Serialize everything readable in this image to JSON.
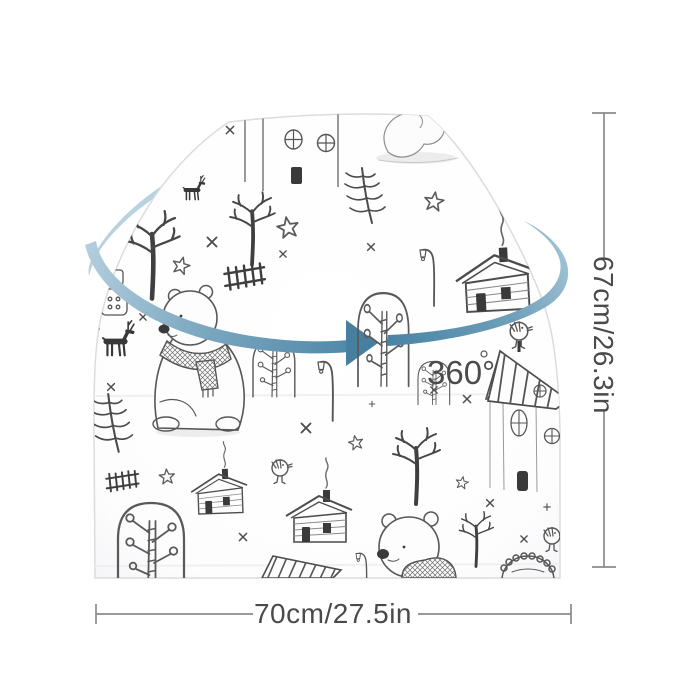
{
  "image": {
    "subject": "Stretchy baby car-seat canopy / nursing cover, white fabric with winter doodle print, shown with 360-degree rotation arrow and size annotations",
    "background": "#ffffff"
  },
  "annotations": {
    "rotation_label": "360°",
    "height_label": "67cm/26.3in",
    "width_label": "70cm/27.5in"
  },
  "colors": {
    "arrow_blue_dark": "#47809f",
    "arrow_blue_mid": "#7ba7c0",
    "arrow_blue_light": "#b6d0de",
    "dimension_line_gray": "#8b8b8b",
    "label_text_gray": "#4a4a4a",
    "doodle_ink": "#565656",
    "doodle_dark_fill": "#3a3a3a",
    "fabric_white": "#fdfdfe"
  },
  "pattern_motifs": [
    "sleeping bear on snow mound",
    "sitting bear with knitted scarf",
    "bear in knit sweater",
    "log cabins with smoking chimneys",
    "tall house with striped gable roof",
    "bare winter trees",
    "pine trees",
    "round bush trees with berry dots",
    "deer silhouettes",
    "small birds",
    "ladder fences",
    "curved street lamps",
    "outline stars",
    "sketch cross marks",
    "scalloped bush dome",
    "hanging tag with button"
  ]
}
